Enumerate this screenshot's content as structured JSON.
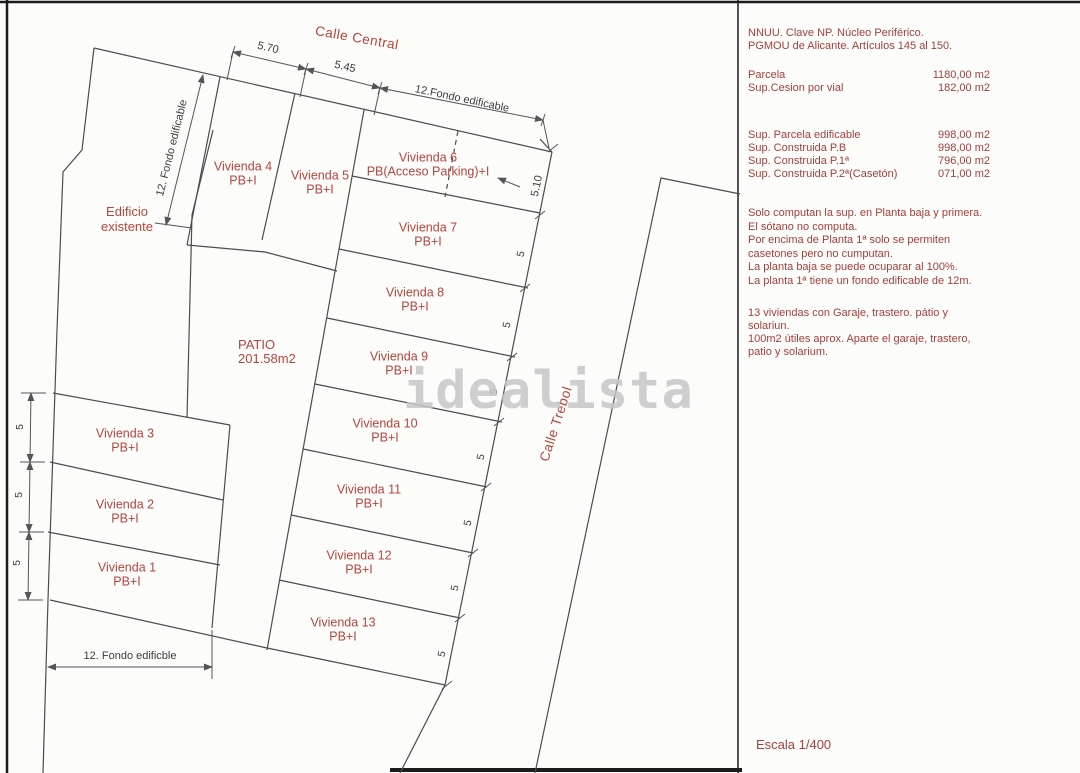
{
  "streets": {
    "central": "Calle Central",
    "trebol": "Calle Trebol"
  },
  "plots": {
    "viviendas": [
      {
        "name": "Vivienda 1",
        "subtitle": "PB+I"
      },
      {
        "name": "Vivienda 2",
        "subtitle": "PB+I"
      },
      {
        "name": "Vivienda 3",
        "subtitle": "PB+I"
      },
      {
        "name": "Vivienda 4",
        "subtitle": "PB+I"
      },
      {
        "name": "Vivienda 5",
        "subtitle": "PB+I"
      },
      {
        "name": "Vivienda 6",
        "subtitle": "PB(Acceso Parking)+I"
      },
      {
        "name": "Vivienda 7",
        "subtitle": "PB+I"
      },
      {
        "name": "Vivienda 8",
        "subtitle": "PB+I"
      },
      {
        "name": "Vivienda 9",
        "subtitle": "PB+I"
      },
      {
        "name": "Vivienda 10",
        "subtitle": "PB+I"
      },
      {
        "name": "Vivienda 11",
        "subtitle": "PB+I"
      },
      {
        "name": "Vivienda 12",
        "subtitle": "PB+I"
      },
      {
        "name": "Vivienda 13",
        "subtitle": "PB+I"
      }
    ],
    "patio": {
      "title": "PATIO",
      "area": "201.58m2"
    },
    "existing_building": {
      "line1": "Edificio",
      "line2": "existente"
    }
  },
  "dimensions": {
    "top": [
      "5.70",
      "5.45",
      "12.Fondo edificable"
    ],
    "left_depth": "12. Fondo edificable",
    "bottom_depth": "12. Fondo edificble",
    "right_top": "5.10",
    "right_fives": [
      "5",
      "5",
      "5",
      "5",
      "5",
      "5",
      "5"
    ],
    "left_fives": [
      "5",
      "5",
      "5"
    ]
  },
  "notes": {
    "regulation": [
      "NNUU. Clave NP. Núcleo Periférico.",
      "PGMOU de Alicante. Artículos 145 al 150."
    ],
    "parcel_rows": [
      {
        "label": "Parcela",
        "value": "1180,00 m2"
      },
      {
        "label": "Sup.Cesion por vial",
        "value": "182,00 m2"
      }
    ],
    "surface_rows": [
      {
        "label": "Sup. Parcela edificable",
        "value": "998,00 m2"
      },
      {
        "label": "Sup. Construida P.B",
        "value": "998,00 m2"
      },
      {
        "label": "Sup. Construida P.1ª",
        "value": "796,00 m2"
      },
      {
        "label": "Sup. Construida P.2ª(Casetón)",
        "value": "071,00 m2"
      }
    ],
    "rules": [
      "Solo computan la sup. en Planta baja y primera. El sótano no computa.",
      "Por encima de Planta 1ª solo se permiten casetones pero no cumputan.",
      "La planta baja se puede ocuparar al 100%.",
      "La planta 1ª tiene un fondo edificable de 12m."
    ],
    "summary": [
      "13 viviendas con Garaje, trastero. pátio y solariun.",
      "100m2 útiles aprox. Aparte el garaje, trastero, patio y solarium."
    ]
  },
  "scale_label": "Escala 1/400",
  "watermark": "idealista",
  "colors": {
    "label_red": "#b5453c",
    "panel_red": "#a2403a",
    "line": "#4c4c4c",
    "watermark_gray": "#c7c7c7"
  }
}
